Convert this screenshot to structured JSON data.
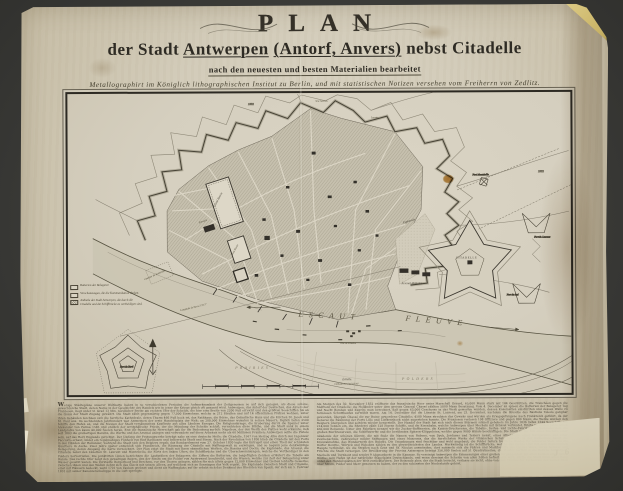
{
  "scan": {
    "background_color": "#3b3b38",
    "paper_color": "#d2cbb9",
    "ink_color": "#2e2b24",
    "stain_color": "#c1883d",
    "tape_color": "#cdb86c",
    "handwritten_mark": "J 6"
  },
  "title": {
    "main": "PLAN",
    "line2_pre": "der Stadt",
    "city": "Antwerpen",
    "alt": "(Antorf, Anvers)",
    "line2_post": "nebst Citadelle",
    "line3": "nach den neuesten und besten Materialien bearbeitet",
    "line4": "Metallographirt im Königlich lithographischen Institut zu Berlin, und mit statistischen Notizen versehen vom Freiherrn von Zedlitz."
  },
  "map": {
    "labels": {
      "section": "5me Section.",
      "year_n": "1832",
      "year_ne": "1832",
      "lunette": "Lunette",
      "fort_montebello": "Fort Montebello",
      "fort_st_laurent": "Fort St. Laurent",
      "fort_du_sud": "Fort du Sud",
      "grand_bassin": "Grand Bassin",
      "petit_bassin": "Petit Bassin",
      "entrepot": "Entrepôt",
      "chantier": "Chantier du Kattendijk",
      "esplanade": "Esplanade",
      "arsenal": "Arsenal Militaire",
      "citadelle": "CITADELLE",
      "escaut": "ESCAUT",
      "fleuve": "FLEUVE",
      "prairies": "PRAIRIES",
      "polders": "POLDERS",
      "tete_de_flandre": "Tête de Flandre",
      "fort_du_nord": "Fort du Nord",
      "meridian": "Longitude de Paris 2°2′15″",
      "scale_label": "Échelle.",
      "scale_sublabel": "Latitude Nord 51°13′16″"
    },
    "legend": {
      "items": [
        "Batterien der Belagerer.",
        "Verschanzungen, die die Kommunikation decken.",
        "Antheile der Stadt Antwerpen, die durch die Citadelle und die Schiffbrücke zu vertheidigen sind."
      ]
    }
  },
  "notes": {
    "columns": [
      "Wenige Städtepläne unserer Weltkarte haben in so verschiedenen Perioden die Aufmerksamkeit der Zeitgenossen so auf sich gezogen, als diese schöne, gewerbreiche Stadt, deren Name in der Geschichte des Handels wie in jener der Kriege gleich oft genannt wird. Antwerpen, das Antorf der Deutschen, das Anvers der Franzosen, liegt unter 51 Grad 13 Min. nördlicher Breite am rechten Ufer der Schelde, die hier eine Breite von 2200 Fuß erreicht und den größten Seeschiffen bis an die Quais der Stadt Zugang gewährt. Die Stadt zählt gegenwärtig gegen 77,000 Einwohner, welche in 212 Straßen und auf 14 öffentlichen Plätzen wohnen; unter ihren Gebäuden zeichnen sich die herrliche Kathedrale, deren Thurm 466 Fuß hoch ist, das Rathhaus, die Börse, das Ostindische Haus und die Kirchen St. Jacob und St. Paul aus. Im sechzehnten Jahrhundert war Antwerpen der erste Handelsplatz der Welt; an 200,000 Einwohner wohnten in seinen Mauern, täglich liefen 2500 Schiffe den Hafen an, und die Messen der Stadt versammelten Kaufleute aus allen Ländern Europas. Die Religionskriege, die Eroberung durch die Spanier unter Alexander von Parma 1585 und endlich der westphälische Friede, der die Mündung der Schelde schloß, vernichteten diese Blüthe, und die Stadt sank zu einem Landplatze von kaum 40,000 Seelen herab. Erst die französische Herrschaft gab ihr die Bedeutung zurück: Napoleon, der den Werth des Platzes wohl erkannte, ließ seit 1803 die großartigen Bassins, die Werfte und das Arsenal anlegen und verwendete auf diese Arbeiten mehr als 60 Millionen Franken; Antwerpen sollte die Pistole sein, auf das Herz Englands gerichtet. Der Umfang der Festungswerke beträgt nahe an eine deutsche Meile; die Citadelle, 1567 von Herzog Alba durch den Ingenieur Pacciotto erbaut, bildet ein regelmäßiges Fünfeck von fünf Bastionen und beherrscht Stadt und Strom. Nach der Revolution von 1830 blieb die Citadelle mit den Forts in den Händen der Holländer, während die Stadt sich den Belgiern ergab; das Bombardement vom 27. October 1830 legte das Entrepôt und einen Theil der schönsten Quartiere in Asche. Zwei Jahre später entschloß sich Frankreich, die Räumung der Citadelle mit Waffengewalt zu erzwingen, und so begann jene denkwürdige Belagerung, deren Ausgang die Karte verzeichnet. Der Plan zeigt die Stadt mit ihren sämmtlichen Werken, die Bassins und Docks, die Esplanade, das Arsenal, die Citadelle nebst den Lünetten St. Laurent und Montebello, die Forts des linken Ufers, die Schiffbrücke und die Überschwemmungen, welche die Vertheidiger in den Polders hervorriefen. Die punktirten Linien bezeichnen die Laufgräben der Belagerer, die Ziffern die Batterien; die beigefügten Zeichen erläutert die Tabelle am Rande. Das rechte Ufer zeigt den gewaltigen Bogen, den der Strom um die Polder von Austruweel beschreibt, und die Wiesen, welche zur Zeit der Belagerung unter Wasser gesetzt waren. Die Vorstädte Borgerhout und Berchem, vor den Thoren gelegen, zählen für sich allein gegen 12,000 Einwohner und treiben lebhafte Gewerbe; zwischen ihnen und den Wällen dehnt sich das Glacis mit seinen Alleen, auf welchem sich an Sonntagen das Volk ergeht. Die Esplanade zwischen Stadt und Citadelle, einst mit Häusern bedeckt, ward 1701 von Vauban geebnet und dient als Waffenplatz; auf ihr erhebt sich das Denkmal des Obersten van Speyk, der sich am 5. Februar 1831 mit seiner Kanonierschaluppe in die Luft sprengte.",
      "Am Morgen des 30. November 1832 eröffnete das französische Heer unter Marschall Gérard, 65,000 Mann stark mit 144 Geschützen, die Tranchéen gegen die Südfront der Citadelle; die Holländer unter dem greisen General Chassé zählten 5000 Mann Besatzung. Vom 4. December an spieen die Batterien der Belagerer Tag und Nacht Bomben und Kugeln; man berechnet, daß gegen 63,000 Geschosse in das Werk geworfen wurden, dessen Kasematten einstürzten und dessen Wälle zu formlosen Schutthaufen zerwühlt waren. Am 14. December fiel die Lünette St. Laurent, am 23. December, nachdem die Bresche des Bastions Toledo gangbar geworden, übergab Chassé die zur Ruine gewordene Citadelle; 4500 Mann streckten das Gewehr und wurden als Kriegsgefangene nach Frankreich geführt, da der General die Räumung der Forts Lillo und Liefkenshoek nicht zugestehen konnte. Die Franzosen verloren 108 Offiziere und gegen 800 Mann; die Werke wurden den Belgiern übergeben und seitdem wieder hergestellt. Der Handel der Stadt hat sich nach diesen Stürmen schnell gehoben: im Jahre 1836 liefen 1344 Seeschiffe mit 214,000 Tonnen ein, die Rhederei zählt 128 eigene Schiffe, und die Eisenbahn, welche Antwerpen über Mecheln mit Brüssel verbindet, führte im ersten Jahre schon 450,000 Reisende. Unter den Fabriken nennen wir die Zucker-Raffinerien, die Kattun-Druckereien, die Tabaks-, Seifen- und Lichte-Fabriken, die Salzsiedereien, die großen Bierbrauereien, die Schiffswerfte und die berühmten Spitzen-Klöppeleien, welche gegen 9000 Hände beschäftigen. Die Stadt ist der Sitz eines Bischofs, einer Akademie der schönen Künste, die mit Stolz die Namen von Rubens, van Dyck, Jordaens und Teniers nennt, eines Athenäums, einer Navigations- und einer Zeichenschule, zahlreicher milder Stiftungen und eines Museums, das die herrlichsten Werke der vlämischen Schule bewahrt; in der Kathedrale hängt die Kreuzabnahme, das Wunderwerk des Rubens. Die Umgebungen sind fruchtbar und wohl angebaut; die Polder liefern treffliche Weiden für schweres Vieh, und die Dörfer Deurne, Wilryck und Hoboken zählen zu den gewerbreichsten des Landes. Merkwürdig ist die Schiffbrücke, welche das rechte Ufer mit dem Flandrischen Haupte verbindet, wo die Straßen nach Gent und St. Nicolas ausmünden; dort sammeln sich die Fähren und Marktschiffe des Landes Waes, deren Gemüse und Früchte die Stadt versorgen. Die Bevölkerung der Provinz Antwerpen beträgt 356,000 Seelen auf 51 Quadratmeilen; die Provinz zerfällt in die Bezirke Antwerpen, Mecheln und Turnhout und sendet 9 Abgeordnete in die Kammer. So vereinigt Antwerpen die Erinnerungen einer großen Vergangenheit mit allen Keimen einer neuen Blüthe: sein Hafen ist der natürliche Stapelplatz Deutschlands, und wenn dereinst die Schelde von allen Zöllen befreit sein wird, dürfte die Stadt ihren alten Rang unter den Handelsplätzen der Welt zurückfordern. Der Reisende aber, der die Stadt besucht, verlasse sie nicht, ohne von dem Thurme der Kathedrale den weiten Blick über Strom, Polder und Meer genossen zu haben, der zu den schönsten der Niederlande gehört."
    ],
    "imprint": "Gedruckt und zu haben im lithographischen Institut zu Berlin."
  }
}
